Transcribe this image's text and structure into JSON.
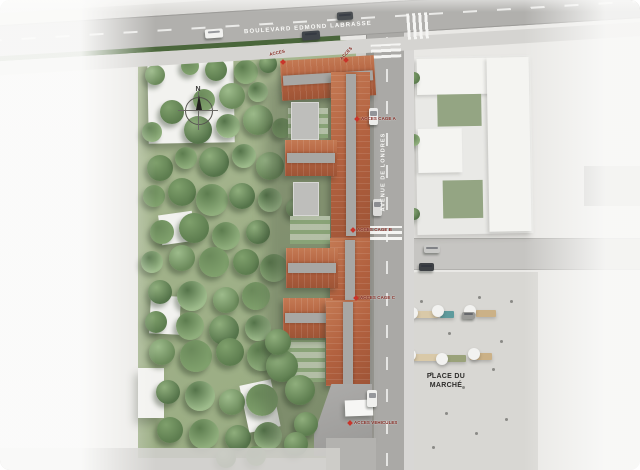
{
  "streets": {
    "boulevard": "BOULEVARD EDMOND LABRASSE",
    "avenue": "AVENUE DE LONDRES"
  },
  "market": {
    "line1": "PLACE DU",
    "line2": "MARCHÉ"
  },
  "compass": {
    "north": "N"
  },
  "access": [
    {
      "id": "top-left",
      "label": "ACCES"
    },
    {
      "id": "top-right",
      "label": "ACCES"
    },
    {
      "id": "cage-a",
      "label": "ACCES CAGE A"
    },
    {
      "id": "cage-b",
      "label": "ACCES CAGE B"
    },
    {
      "id": "cage-c",
      "label": "ACCES CAGE C"
    },
    {
      "id": "vehicules",
      "label": "ACCES VEHICULES"
    }
  ],
  "colors": {
    "roof": "#b2613f",
    "roof_light": "#c47a54",
    "access_marker": "#c9342a",
    "hedge": "#4a663b",
    "grass": "#a0b189",
    "road": "#aaa9a6",
    "market_paving": "#d8d7d3"
  }
}
